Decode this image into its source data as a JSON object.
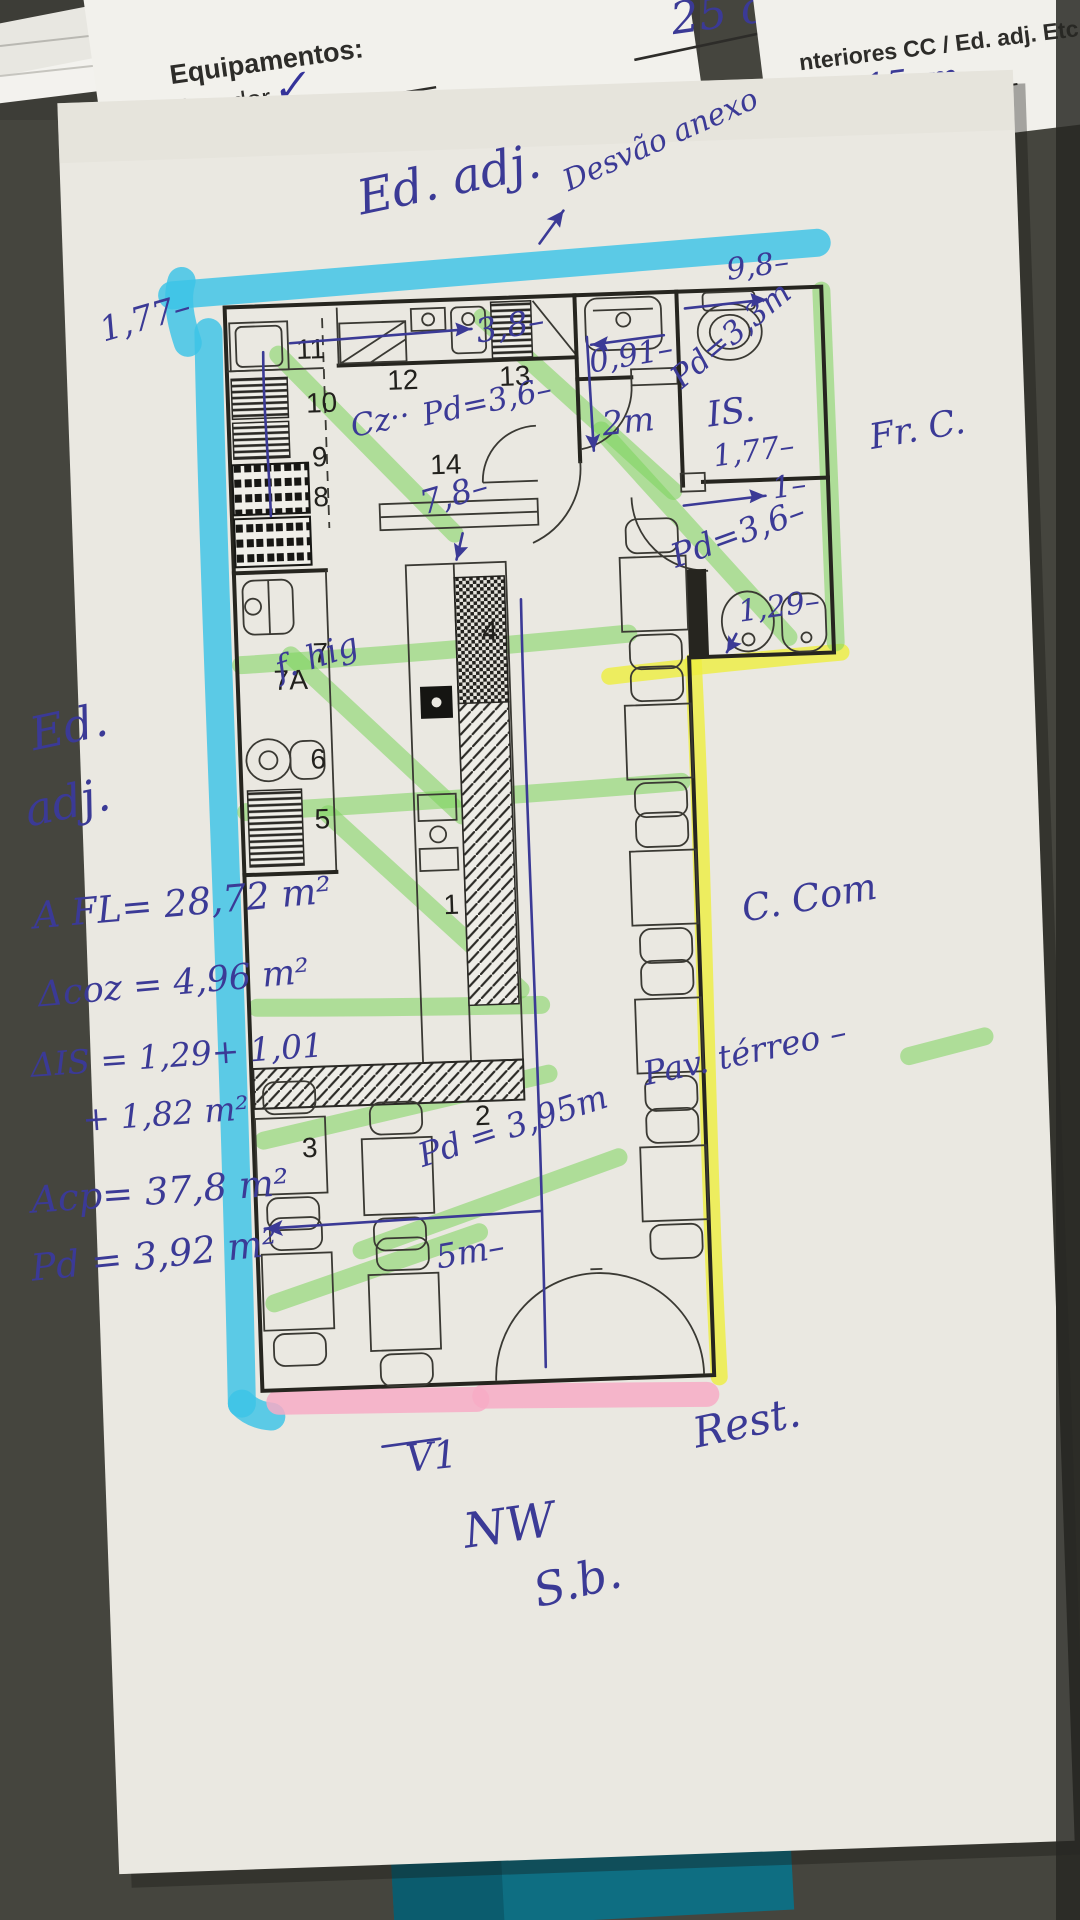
{
  "sheets": {
    "equipment_header": "Equipamentos:",
    "equipment_item1": "Elevador",
    "equipment_check": "✓",
    "equipment_item2": "Rede de Gá",
    "top_measure": "25 cm",
    "form_title": "nteriores CC / Ed. adj. Etc.:",
    "form_field": "ra:",
    "form_value": "15cm"
  },
  "rooms": {
    "r1": "1",
    "r2": "2",
    "r3": "3",
    "r4": "4",
    "r5": "5",
    "r6": "6",
    "r7": "7",
    "r7a": "7A",
    "r8": "8",
    "r9": "9",
    "r10": "10",
    "r11": "11",
    "r12": "12",
    "r13": "13",
    "r14": "14"
  },
  "ann": {
    "ed_adj_top": "Ed. adj.",
    "desvao": "Desvão anexo",
    "d98": "9,8–",
    "d091": "0,91–",
    "pd33": "Pd=3,3m",
    "d38": "3,8–",
    "d2m": "2m",
    "is_label": "IS.",
    "d177_right": "1,77–",
    "d1": "1–",
    "pd36_right": "Pd=3,6–",
    "d129": "1,29–",
    "d177_left": "1,77–",
    "cz": "Cz··",
    "pd36_kitchen": "Pd=3,6–",
    "d78": "7,8–",
    "f_hig": "f. hig",
    "ed_left1": "Ed.",
    "ed_left2": "adj.",
    "a_fl": "A FL= 28,72 m²",
    "a_coz": "Δcoz = 4,96 m²",
    "a_is1": "ΔIS = 1,29+ 1,01",
    "a_is2": "+ 1,82 m²",
    "a_cp": "Acp= 37,8 m²",
    "pd_total": "Pd = 3,92 m²",
    "fr_c": "Fr. C.",
    "c_com": "C. Com",
    "pav_terreo": "Pav. térreo –",
    "pd395": "Pd = 3,95m",
    "d5m": "5m–",
    "v1": "V1",
    "nw": "NW",
    "sb": "S.b.",
    "rest": "Rest."
  },
  "colors": {
    "ink_blue": "#3b3a96",
    "highlight_cyan": "#3cc3e6",
    "highlight_green": "#7cd45c",
    "highlight_yellow": "#eeee3e",
    "highlight_pink": "#f7abc6",
    "paper": "#eae8e1",
    "plan_line": "#26251f",
    "background": "#45453e",
    "teal_object": "#0e6e82"
  }
}
